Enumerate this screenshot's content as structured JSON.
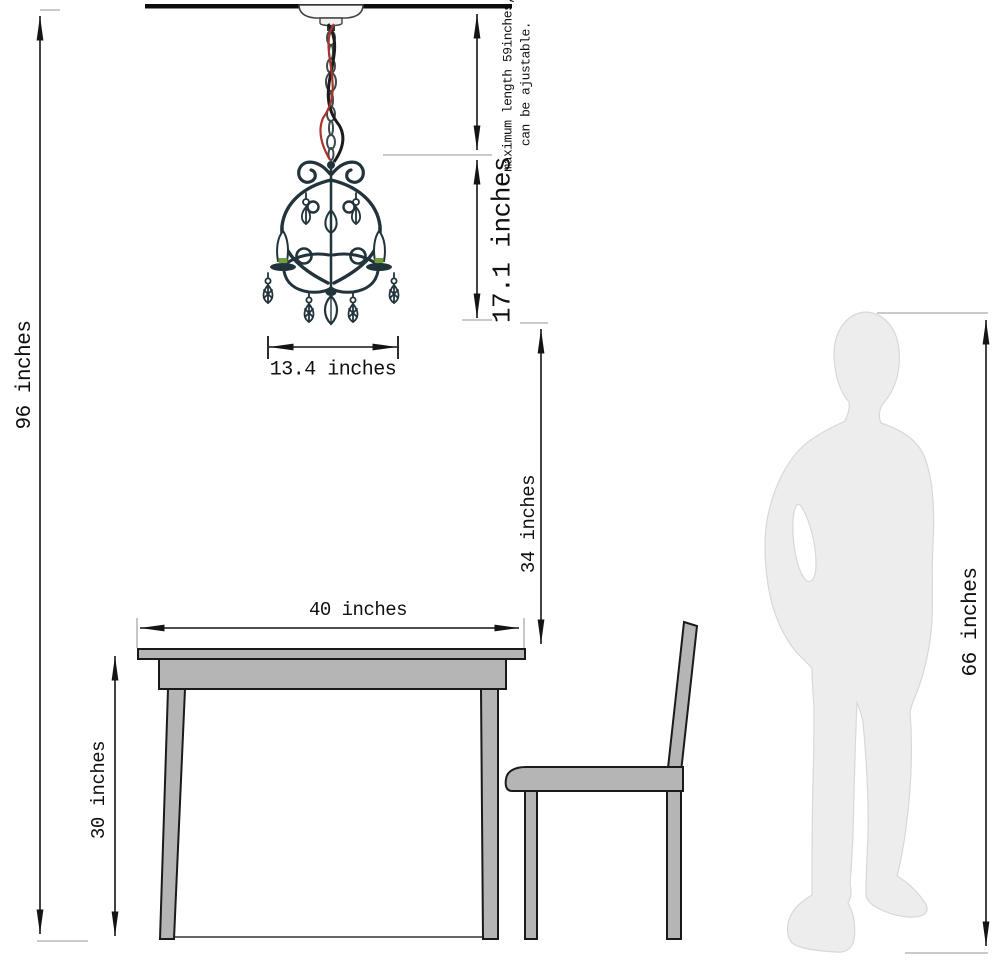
{
  "labels": {
    "overall_height": "96 inches",
    "fixture_height": "17.1 inches",
    "fixture_width": "13.4 inches",
    "ceiling_to_table": "34 inches",
    "table_width": "40 inches",
    "table_height": "30 inches",
    "person_height": "66 inches"
  },
  "note": {
    "line1": "maximum length 59inches,",
    "line2": "can be ajustable."
  },
  "colors": {
    "dimension_line": "#141414",
    "extension_tick": "#b9b9b9",
    "furniture_fill": "#b5b5b5",
    "silhouette_fill": "#ededed",
    "silhouette_outline": "#d8d8d8",
    "chandelier_metal": "#22343b",
    "wire_red": "#a8352b",
    "candle_green": "#6f9e3f",
    "ceiling": "#0d0d0d"
  }
}
